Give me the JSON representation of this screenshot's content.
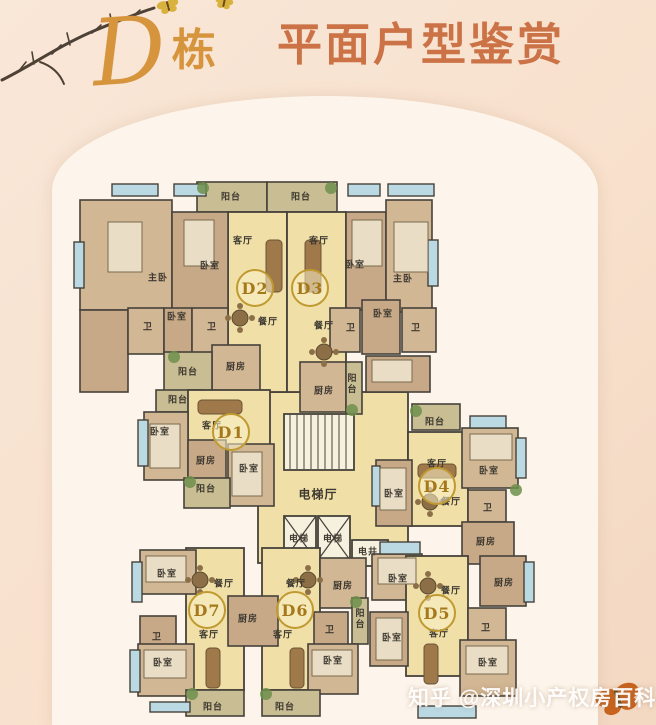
{
  "header": {
    "building_letter": "D",
    "building_suffix": "栋",
    "title": "平面户型鉴赏"
  },
  "watermark": {
    "text": "知乎 @深圳小产权房百科"
  },
  "colors": {
    "accent_orange": "#cb7347",
    "building_gold": "#d6953d",
    "badge_gold_border": "#c09a30",
    "badge_gold_text": "#a5791b",
    "wall": "#46423a",
    "hall_fill": "#f0e0a8",
    "room_fill": "#d2b795",
    "balcony_fill": "#c9bd93",
    "window_fill": "#bad9e3",
    "panel_bg": "#fdf5eb",
    "page_bg": "#f8e1cd",
    "watermark_color": "#ffffff",
    "plant_green": "#6d8f4b",
    "butterfly_gold": "#d8b23c",
    "butterfly_orange": "#c8641e"
  },
  "plan": {
    "units": [
      {
        "id": "D1",
        "x": 231,
        "y": 432
      },
      {
        "id": "D2",
        "x": 255,
        "y": 288
      },
      {
        "id": "D3",
        "x": 310,
        "y": 288
      },
      {
        "id": "D4",
        "x": 437,
        "y": 486
      },
      {
        "id": "D5",
        "x": 437,
        "y": 613
      },
      {
        "id": "D6",
        "x": 295,
        "y": 610
      },
      {
        "id": "D7",
        "x": 207,
        "y": 610
      }
    ],
    "labels": [
      {
        "t": "阳台",
        "x": 231,
        "y": 196
      },
      {
        "t": "阳台",
        "x": 301,
        "y": 196
      },
      {
        "t": "客厅",
        "x": 243,
        "y": 240
      },
      {
        "t": "客厅",
        "x": 319,
        "y": 240
      },
      {
        "t": "主卧",
        "x": 158,
        "y": 277
      },
      {
        "t": "卧室",
        "x": 210,
        "y": 265
      },
      {
        "t": "卧室",
        "x": 355,
        "y": 264
      },
      {
        "t": "主卧",
        "x": 403,
        "y": 278
      },
      {
        "t": "卧室",
        "x": 177,
        "y": 316
      },
      {
        "t": "卫",
        "x": 148,
        "y": 326
      },
      {
        "t": "卫",
        "x": 212,
        "y": 326
      },
      {
        "t": "卫",
        "x": 351,
        "y": 327
      },
      {
        "t": "卫",
        "x": 416,
        "y": 327
      },
      {
        "t": "卧室",
        "x": 383,
        "y": 313
      },
      {
        "t": "餐厅",
        "x": 268,
        "y": 321
      },
      {
        "t": "餐厅",
        "x": 324,
        "y": 325
      },
      {
        "t": "厨房",
        "x": 236,
        "y": 366
      },
      {
        "t": "阳台",
        "x": 188,
        "y": 371
      },
      {
        "t": "厨房",
        "x": 324,
        "y": 390
      },
      {
        "t": "阳台",
        "x": 352,
        "y": 384,
        "v": true
      },
      {
        "t": "阳台",
        "x": 178,
        "y": 399
      },
      {
        "t": "客厅",
        "x": 212,
        "y": 425
      },
      {
        "t": "卧室",
        "x": 160,
        "y": 431
      },
      {
        "t": "厨房",
        "x": 206,
        "y": 460
      },
      {
        "t": "卧室",
        "x": 249,
        "y": 468
      },
      {
        "t": "阳台",
        "x": 206,
        "y": 488
      },
      {
        "t": "电梯厅",
        "x": 318,
        "y": 494,
        "s": 12
      },
      {
        "t": "电梯",
        "x": 299,
        "y": 538
      },
      {
        "t": "电梯",
        "x": 333,
        "y": 538
      },
      {
        "t": "电井",
        "x": 368,
        "y": 551
      },
      {
        "t": "阳台",
        "x": 435,
        "y": 421
      },
      {
        "t": "客厅",
        "x": 437,
        "y": 463
      },
      {
        "t": "卧室",
        "x": 489,
        "y": 470
      },
      {
        "t": "卧室",
        "x": 394,
        "y": 493
      },
      {
        "t": "餐厅",
        "x": 451,
        "y": 501
      },
      {
        "t": "卫",
        "x": 488,
        "y": 507
      },
      {
        "t": "厨房",
        "x": 486,
        "y": 541
      },
      {
        "t": "卧室",
        "x": 167,
        "y": 573
      },
      {
        "t": "餐厅",
        "x": 224,
        "y": 583
      },
      {
        "t": "餐厅",
        "x": 296,
        "y": 583
      },
      {
        "t": "厨房",
        "x": 343,
        "y": 585
      },
      {
        "t": "厨房",
        "x": 248,
        "y": 618
      },
      {
        "t": "卫",
        "x": 157,
        "y": 636
      },
      {
        "t": "客厅",
        "x": 209,
        "y": 634
      },
      {
        "t": "客厅",
        "x": 283,
        "y": 634
      },
      {
        "t": "卫",
        "x": 330,
        "y": 629
      },
      {
        "t": "阳台",
        "x": 360,
        "y": 619,
        "v": true
      },
      {
        "t": "卧室",
        "x": 163,
        "y": 662
      },
      {
        "t": "卧室",
        "x": 333,
        "y": 660
      },
      {
        "t": "阳台",
        "x": 213,
        "y": 706
      },
      {
        "t": "阳台",
        "x": 285,
        "y": 706
      },
      {
        "t": "卧室",
        "x": 398,
        "y": 578
      },
      {
        "t": "餐厅",
        "x": 451,
        "y": 590
      },
      {
        "t": "厨房",
        "x": 504,
        "y": 582
      },
      {
        "t": "客厅",
        "x": 439,
        "y": 633
      },
      {
        "t": "卫",
        "x": 486,
        "y": 627
      },
      {
        "t": "卧室",
        "x": 392,
        "y": 637
      },
      {
        "t": "卧室",
        "x": 488,
        "y": 662
      }
    ]
  }
}
